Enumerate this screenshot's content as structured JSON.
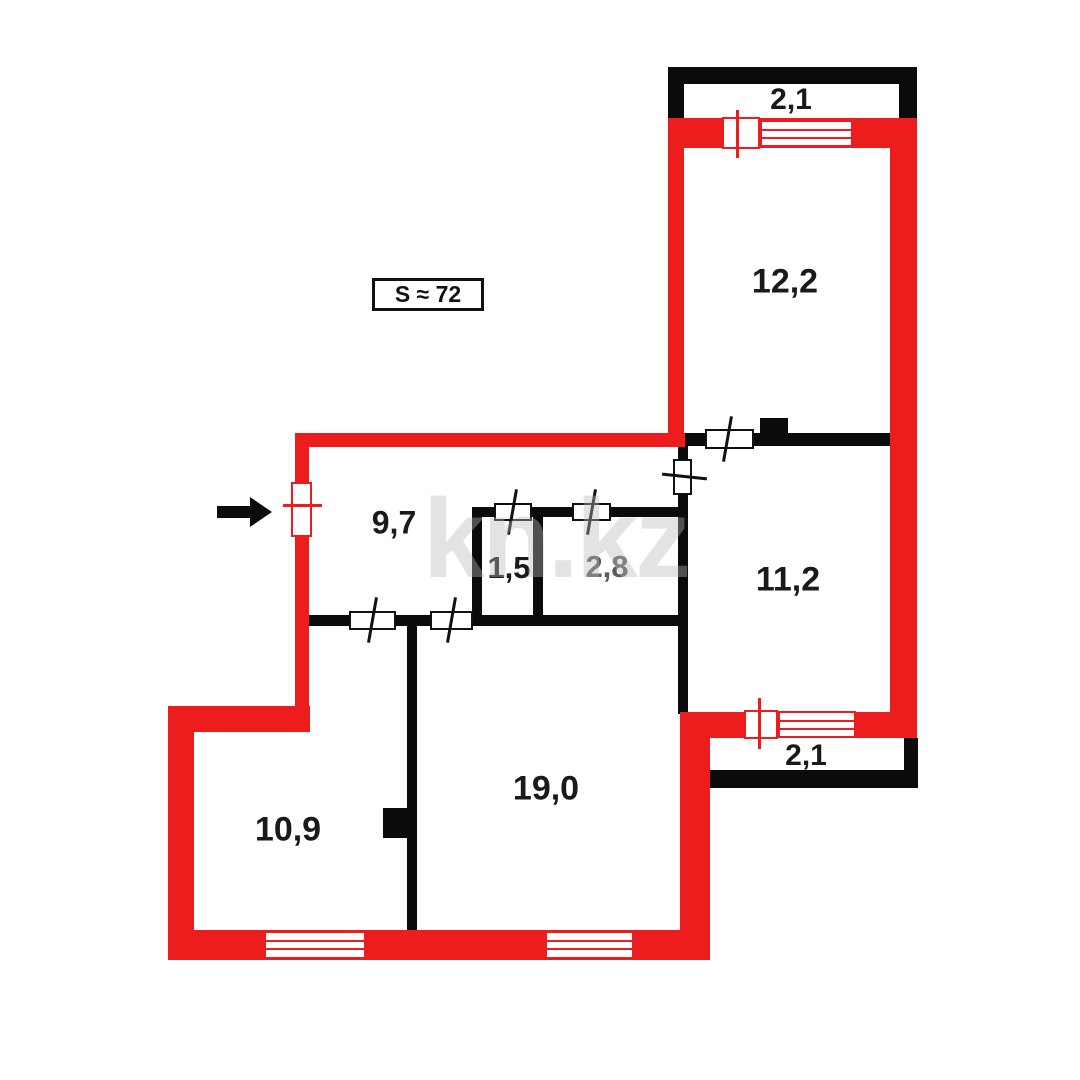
{
  "title_badge": {
    "area_label": "S ≈ 72"
  },
  "watermark": "kn.kz",
  "colors": {
    "exterior_wall": "#ed1d1d",
    "interior_wall": "#0b0b0b",
    "label": "#1a1a1a",
    "muted_label": "#5a5a5a"
  },
  "rooms": [
    {
      "name": "balcony-top",
      "area": "2,1"
    },
    {
      "name": "bedroom-top",
      "area": "12,2"
    },
    {
      "name": "room-right",
      "area": "11,2"
    },
    {
      "name": "hallway",
      "area": "9,7"
    },
    {
      "name": "bathroom",
      "area": "1,5"
    },
    {
      "name": "toilet",
      "area": "2,8"
    },
    {
      "name": "living-room",
      "area": "19,0"
    },
    {
      "name": "bedroom-left",
      "area": "10,9"
    },
    {
      "name": "balcony-bottom",
      "area": "2,1"
    }
  ],
  "entrance": {
    "symbol": "arrow-right"
  }
}
